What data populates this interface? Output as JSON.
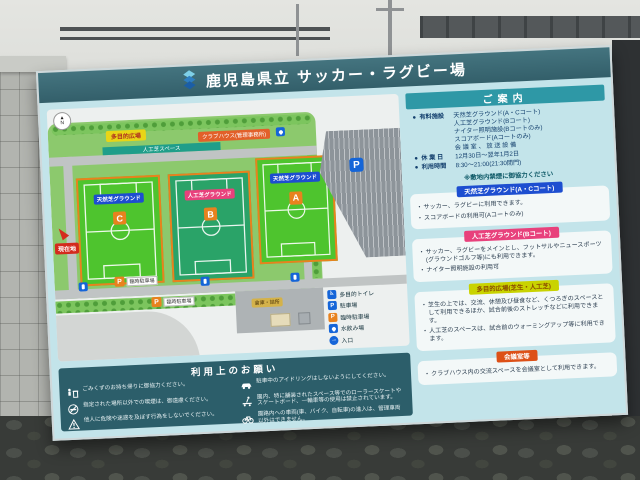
{
  "colors": {
    "header_teal": "#3a6b76",
    "board_cyan": "#c3e4ea",
    "guide_bar_teal": "#2e98a6",
    "notes_teal": "#2c5e6a",
    "natural_turf_badge": "#1d4ed0",
    "artificial_turf_badge": "#e8417c",
    "plaza_badge": "#c9d300",
    "meeting_badge": "#dd5017",
    "field_border_orange": "#e8821e",
    "you_are_here_red": "#d42a1e"
  },
  "sign": {
    "title": "鹿児島県立 サッカー・ラグビー場"
  },
  "map": {
    "north": "N",
    "plaza_label": "多目的広場",
    "turf_space_label": "人工芝スペース",
    "clubhouse_label": "クラブハウス(管理事務所)",
    "fields": [
      {
        "type_label": "天然芝グラウンド",
        "letter": "C"
      },
      {
        "type_label": "人工芝グラウンド",
        "letter": "B"
      },
      {
        "type_label": "天然芝グラウンド",
        "letter": "A"
      }
    ],
    "you_are_here": "現在地",
    "parking_letter": "P",
    "temp_parking_label": "臨時駐車場",
    "storage_label": "倉庫・詰所",
    "legend": [
      {
        "icon": "accessible-toilet-icon",
        "label": "多目的トイレ"
      },
      {
        "icon": "parking-icon",
        "label": "駐車場"
      },
      {
        "icon": "temp-parking-icon",
        "label": "臨時駐車場"
      },
      {
        "icon": "fountain-icon",
        "label": "水飲み場"
      },
      {
        "icon": "entrance-icon",
        "label": "入口"
      }
    ]
  },
  "guide": {
    "title": "ご案内",
    "info": [
      {
        "label": "有料施設",
        "lines": [
          "天然芝グラウンド(A・Cコート)",
          "人工芝グラウンド(Bコート)",
          "ナイター照明施設(Bコートのみ)",
          "スコアボード(Aコートのみ)",
          "会 議 室 、 放 送 設 備"
        ]
      },
      {
        "label": "休 業 日",
        "lines": [
          "12月30日～翌年1月2日"
        ]
      },
      {
        "label": "利用時間",
        "lines": [
          "8:30～21:00(21:30閉門)"
        ]
      }
    ],
    "smoking_note": "※敷地内禁煙に御協力ください",
    "sections": [
      {
        "badge": "天然芝グラウンド(A・Cコート)",
        "items": [
          "サッカー、ラグビーに利用できます。",
          "スコアボードの利用可(Aコートのみ)"
        ]
      },
      {
        "badge": "人工芝グラウンド(Bコート)",
        "items": [
          "サッカー、ラグビーをメインとし、フットサルやニュースポーツ(グラウンドゴルフ等)にも利用できます。",
          "ナイター照明施設の利用可"
        ]
      },
      {
        "badge": "多目的広場(芝生・人工芝)",
        "items": [
          "芝生の上では、交流、休憩及び昼食など、くつろぎのスペースとして利用できるほか、試合前後のストレッチなどに利用できます。",
          "人工芝のスペースは、試合前のウォーミングアップ等に利用できます。"
        ]
      },
      {
        "badge": "会議室等",
        "items": [
          "クラブハウス内の交流スペースを会議室として利用できます。"
        ]
      }
    ]
  },
  "notes": {
    "title": "利用上のお願い",
    "left": [
      {
        "icon": "trash-icon",
        "text": "ごみくずのお持ち帰りに御協力ください。"
      },
      {
        "icon": "no-smoking-icon",
        "text": "指定された場所以外での喫煙は、御遠慮ください。"
      },
      {
        "icon": "caution-icon",
        "text": "他人に危険や迷惑を及ぼす行為をしないでください。"
      }
    ],
    "right": [
      {
        "icon": "car-icon",
        "text": "駐車中のアイドリングはしないようにしてください。"
      },
      {
        "icon": "skateboard-icon",
        "text": "園内、特に舗装されたスペース等でのローラースケートやスケートボード、一輪車等の使用は禁止されています。"
      },
      {
        "icon": "bicycle-icon",
        "text": "園路内への車両(車、バイク、自転車)の進入は、管理車両以外はできません。"
      }
    ]
  }
}
